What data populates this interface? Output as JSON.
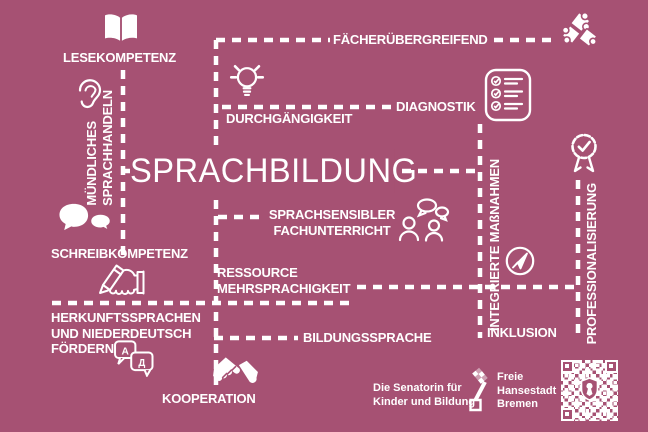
{
  "colors": {
    "background": "#a65173",
    "text": "#ffffff"
  },
  "title": {
    "text": "SPRACHBILDUNG"
  },
  "nodes": {
    "lesekompetenz": "LESEKOMPETENZ",
    "muendliches_sprachhandeln": {
      "line1": "MÜNDLICHES",
      "line2": "SPRACHHANDELN"
    },
    "schreibkompetenz": "SCHREIBKOMPETENZ",
    "herkunftssprachen": {
      "line1": "HERKUNFTSSPRACHEN",
      "line2": "UND NIEDERDEUTSCH",
      "line3": "FÖRDERN"
    },
    "kooperation": "KOOPERATION",
    "faecheruebergreifend": "FÄCHERÜBERGREIFEND",
    "durchgaengigkeit": "DURCHGÄNGIGKEIT",
    "diagnostik": "DIAGNOSTIK",
    "sprachsensibler_fachunterricht": {
      "line1": "SPRACHSENSIBLER",
      "line2": "FACHUNTERRICHT"
    },
    "ressource_mehrsprachigkeit": {
      "line1": "RESSOURCE",
      "line2": "MEHRSPRACHIGKEIT"
    },
    "bildungssprache": "BILDUNGSSPRACHE",
    "integrierte_massnahmen": "INTEGRIERTE MAßNAHMEN",
    "inklusion": "INKLUSION",
    "professionalisierung": "PROFESSIONALISIERUNG"
  },
  "translate_icon_letters": {
    "latin": "A",
    "cyrillic": "Д"
  },
  "footer": {
    "senatorin": {
      "line1": "Die Senatorin für",
      "line2": "Kinder und Bildung"
    },
    "bremen": {
      "line1": "Freie",
      "line2": "Hansestadt",
      "line3": "Bremen"
    }
  },
  "icons": {
    "open-book-icon": "open book",
    "ear-icon": "ear / listening",
    "speech-bubbles-icon": "two chat bubbles",
    "pencil-hand-icon": "hand writing with pencil",
    "translate-icon": "translation bubbles A/Д",
    "handshake-icon": "handshake",
    "lightbulb-icon": "idea lightbulb",
    "checklist-icon": "diagnostic checklist",
    "puzzle-icon": "interlocking puzzle pieces",
    "people-talk-icon": "two people in conversation",
    "compass-icon": "navigation compass arrow",
    "badge-icon": "certified seal with checkmark",
    "bremen-key-icon": "Bremen key emblem",
    "qr-icon": "QR code"
  }
}
